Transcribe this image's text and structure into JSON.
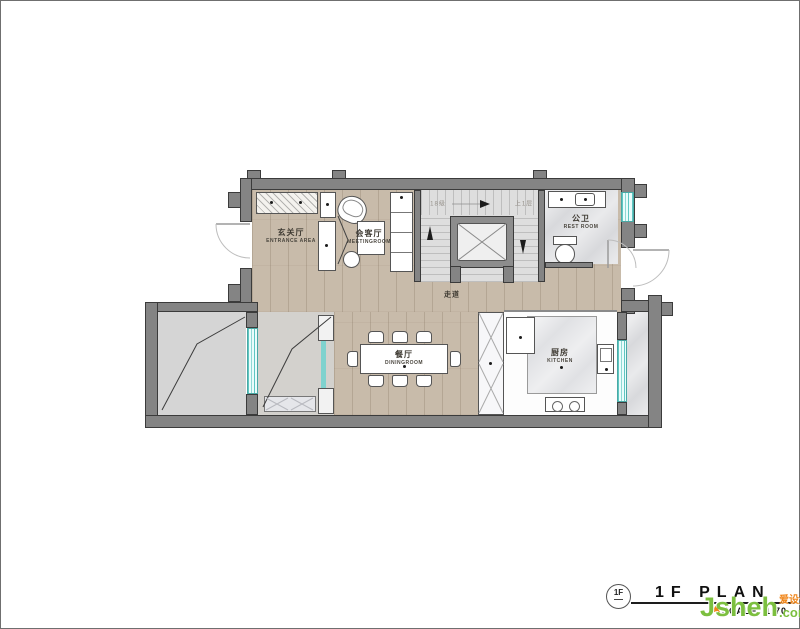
{
  "rooms": {
    "entrance": {
      "cn": "玄关厅",
      "en": "ENTRANCE AREA"
    },
    "meeting": {
      "cn": "会客厅",
      "en": "MEETINGROOM"
    },
    "restroom": {
      "cn": "公卫",
      "en": "REST ROOM"
    },
    "corridor": {
      "cn": "走道"
    },
    "dining": {
      "cn": "餐厅",
      "en": "DININGROOM"
    },
    "kitchen": {
      "cn": "厨房",
      "en": "KITCHEN"
    }
  },
  "stairs": {
    "steps_note": "18级",
    "up_note": "上1层"
  },
  "title_block": {
    "bubble_label": "1F",
    "title": "1F  PLAN",
    "scale_label": "SCALE:",
    "scale_value": "1:70"
  },
  "watermark": {
    "brand": "Jsheh",
    "suffix": ".com",
    "cn_tag": "爱设汇"
  },
  "colors": {
    "wall": "#848484",
    "wall_outline": "#3b3b3b",
    "wood_floor": "#c8bbaa",
    "marble_floor": "#d8d9dc",
    "stair_floor": "#dedede",
    "window_glass": "#5fc6c2",
    "watermark_green": "#7cbf3f",
    "watermark_orange": "#f08519"
  }
}
